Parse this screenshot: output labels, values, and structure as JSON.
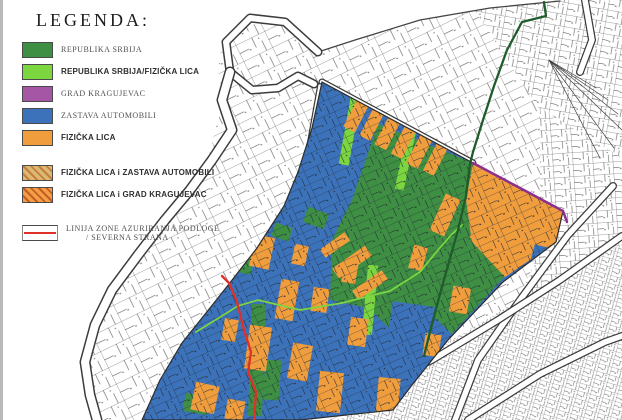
{
  "legend": {
    "title": "LEGENDA:",
    "items": [
      {
        "label": "REPUBLIKA SRBIJA",
        "style": "serif",
        "swatch": {
          "type": "solid",
          "color": "#3E8E43"
        }
      },
      {
        "label": "REPUBLIKA SRBIJA/FIZIČKA LICA",
        "style": "bold",
        "swatch": {
          "type": "solid",
          "color": "#7CD63F"
        }
      },
      {
        "label": "GRAD KRAGUJEVAC",
        "style": "serif",
        "swatch": {
          "type": "solid",
          "color": "#A557A5"
        }
      },
      {
        "label": "ZASTAVA AUTOMOBILI",
        "style": "serif",
        "swatch": {
          "type": "solid",
          "color": "#3B72BA"
        }
      },
      {
        "label": "FIZIČKA LICA",
        "style": "bold",
        "swatch": {
          "type": "solid",
          "color": "#F09D3D"
        }
      },
      {
        "label": "FIZIČKA LICA i ZASTAVA AUTOMOBILI",
        "style": "bold",
        "gap": "lg",
        "swatch": {
          "type": "hatch",
          "base": "#D9B878",
          "stripe": "#C87F35"
        }
      },
      {
        "label": "FIZIČKA LICA i GRAD KRAGUJEVAC",
        "style": "bold",
        "swatch": {
          "type": "hatch",
          "base": "#F0A043",
          "stripe": "#C85A28"
        }
      },
      {
        "label": "LINIJA ZONE AZURIRANJA PODLOGE",
        "label_line2": "/ SEVERNA STRANA",
        "style": "serif",
        "gap": "xl",
        "swatch": {
          "type": "redline",
          "color": "#E03028"
        }
      }
    ]
  },
  "map": {
    "palette": {
      "blue": "#3B72BA",
      "dark_green": "#3E8E43",
      "light_green": "#7CD63F",
      "orange": "#F09D3D",
      "purple": "#8E2F8E",
      "red": "#E03028",
      "dark_green_line": "#1E5C2A",
      "band_edge": "#3c3c3c",
      "white": "#ffffff",
      "zone_outline": "#2b2b2b"
    },
    "outer_top_boundary": [
      [
        560,
        1
      ],
      [
        490,
        8
      ],
      [
        420,
        20
      ],
      [
        355,
        40
      ],
      [
        318,
        52
      ]
    ],
    "white_left": [
      [
        0,
        0
      ],
      [
        300,
        0
      ],
      [
        312,
        46
      ],
      [
        282,
        20
      ],
      [
        248,
        16
      ],
      [
        222,
        40
      ],
      [
        218,
        72
      ],
      [
        224,
        100
      ],
      [
        214,
        135
      ],
      [
        208,
        160
      ],
      [
        186,
        192
      ],
      [
        160,
        224
      ],
      [
        133,
        258
      ],
      [
        107,
        292
      ],
      [
        90,
        327
      ],
      [
        80,
        364
      ],
      [
        85,
        397
      ],
      [
        92,
        420
      ],
      [
        0,
        420
      ]
    ],
    "white_top_wedge": [
      [
        300,
        0
      ],
      [
        560,
        0
      ],
      [
        490,
        8
      ],
      [
        420,
        20
      ],
      [
        355,
        40
      ],
      [
        318,
        52
      ],
      [
        312,
        46
      ]
    ],
    "hook_band": [
      [
        318,
        52
      ],
      [
        285,
        22
      ],
      [
        250,
        18
      ],
      [
        226,
        42
      ],
      [
        230,
        72
      ],
      [
        252,
        90
      ],
      [
        278,
        88
      ],
      [
        298,
        76
      ],
      [
        314,
        84
      ]
    ],
    "main_band": [
      [
        230,
        72
      ],
      [
        222,
        100
      ],
      [
        232,
        130
      ],
      [
        212,
        160
      ],
      [
        190,
        190
      ],
      [
        165,
        220
      ],
      [
        138,
        255
      ],
      [
        112,
        290
      ],
      [
        95,
        325
      ],
      [
        85,
        362
      ],
      [
        90,
        395
      ],
      [
        97,
        420
      ]
    ],
    "edge_road": [
      [
        322,
        82
      ],
      [
        473,
        163
      ]
    ],
    "left_edge_road": [
      [
        320,
        86
      ],
      [
        309,
        148
      ],
      [
        297,
        190
      ]
    ],
    "roads": [
      [
        [
          613,
          186
        ],
        [
          568,
          235
        ],
        [
          520,
          300
        ],
        [
          478,
          360
        ],
        [
          455,
          420
        ]
      ],
      [
        [
          622,
          236
        ],
        [
          560,
          280
        ],
        [
          498,
          320
        ],
        [
          432,
          360
        ],
        [
          352,
          396
        ],
        [
          298,
          418
        ]
      ],
      [
        [
          468,
          420
        ],
        [
          540,
          374
        ],
        [
          605,
          342
        ],
        [
          622,
          336
        ]
      ],
      [
        [
          585,
          0
        ],
        [
          592,
          40
        ],
        [
          580,
          72
        ]
      ]
    ],
    "fan_center": [
      549,
      60
    ],
    "fan_ends": [
      [
        596,
        88
      ],
      [
        608,
        100
      ],
      [
        618,
        114
      ],
      [
        622,
        130
      ],
      [
        614,
        148
      ],
      [
        600,
        158
      ]
    ],
    "districts": [
      {
        "poly": [
          [
            468,
            0
          ],
          [
            622,
            0
          ],
          [
            622,
            160
          ],
          [
            540,
            110
          ]
        ],
        "pattern": "pB"
      },
      {
        "poly": [
          [
            540,
            108
          ],
          [
            622,
            158
          ],
          [
            622,
            420
          ],
          [
            560,
            420
          ],
          [
            505,
            330
          ],
          [
            540,
            250
          ]
        ],
        "pattern": "pBr"
      },
      {
        "poly": [
          [
            340,
            420
          ],
          [
            448,
            342
          ],
          [
            530,
            294
          ],
          [
            622,
            244
          ],
          [
            622,
            420
          ]
        ],
        "pattern": "pC"
      }
    ],
    "zone": [
      [
        322,
        82
      ],
      [
        473,
        163
      ],
      [
        563,
        211
      ],
      [
        556,
        242
      ],
      [
        503,
        282
      ],
      [
        448,
        340
      ],
      [
        412,
        385
      ],
      [
        393,
        410
      ],
      [
        300,
        420
      ],
      [
        142,
        420
      ],
      [
        160,
        380
      ],
      [
        182,
        343
      ],
      [
        206,
        313
      ],
      [
        229,
        284
      ],
      [
        257,
        248
      ],
      [
        284,
        206
      ],
      [
        298,
        172
      ],
      [
        312,
        128
      ]
    ],
    "green_region": [
      [
        378,
        124
      ],
      [
        473,
        163
      ],
      [
        466,
        200
      ],
      [
        472,
        242
      ],
      [
        505,
        276
      ],
      [
        452,
        334
      ],
      [
        425,
        308
      ],
      [
        398,
        336
      ],
      [
        368,
        308
      ],
      [
        330,
        300
      ],
      [
        332,
        240
      ],
      [
        352,
        200
      ]
    ],
    "tip_orange": [
      [
        473,
        163
      ],
      [
        563,
        211
      ],
      [
        556,
        242
      ],
      [
        505,
        277
      ],
      [
        472,
        242
      ],
      [
        466,
        200
      ]
    ],
    "blue_in_green": [
      [
        [
          412,
          322,
          44,
          36,
          8
        ]
      ],
      [
        [
          540,
          256,
          16,
          20,
          15
        ]
      ]
    ],
    "green_in_blue": [
      [
        240,
        262,
        26,
        20,
        15
      ],
      [
        257,
        360,
        14,
        112,
        2
      ],
      [
        196,
        404,
        24,
        18,
        10
      ],
      [
        316,
        218,
        22,
        16,
        20
      ],
      [
        282,
        232,
        18,
        14,
        18
      ],
      [
        272,
        380,
        16,
        40,
        4
      ]
    ],
    "light_green_strips": [
      [
        352,
        118,
        10,
        95,
        10
      ],
      [
        408,
        148,
        9,
        85,
        12
      ],
      [
        370,
        300,
        10,
        70,
        5
      ]
    ],
    "orange_band": [
      [
        356,
        116,
        13,
        30,
        27
      ],
      [
        372,
        124,
        12,
        32,
        27
      ],
      [
        388,
        132,
        13,
        34,
        27
      ],
      [
        404,
        141,
        12,
        34,
        27
      ],
      [
        420,
        150,
        13,
        36,
        27
      ],
      [
        436,
        158,
        12,
        34,
        27
      ]
    ],
    "orange_parcels": [
      [
        262,
        252,
        20,
        32,
        12
      ],
      [
        287,
        300,
        18,
        40,
        10
      ],
      [
        258,
        348,
        22,
        44,
        8
      ],
      [
        300,
        362,
        20,
        36,
        10
      ],
      [
        205,
        398,
        24,
        28,
        12
      ],
      [
        235,
        410,
        18,
        20,
        10
      ],
      [
        330,
        392,
        24,
        40,
        6
      ],
      [
        358,
        332,
        18,
        28,
        8
      ],
      [
        388,
        398,
        22,
        40,
        5
      ],
      [
        350,
        272,
        14,
        22,
        10
      ],
      [
        418,
        258,
        14,
        24,
        15
      ],
      [
        300,
        255,
        14,
        20,
        12
      ],
      [
        320,
        300,
        16,
        24,
        8
      ],
      [
        230,
        330,
        14,
        22,
        10
      ],
      [
        352,
        262,
        40,
        12,
        -35
      ],
      [
        370,
        285,
        36,
        11,
        -35
      ],
      [
        335,
        245,
        30,
        10,
        -35
      ],
      [
        488,
        225,
        26,
        36,
        20
      ],
      [
        518,
        246,
        20,
        28,
        20
      ],
      [
        445,
        215,
        16,
        40,
        24
      ],
      [
        460,
        300,
        18,
        26,
        10
      ],
      [
        432,
        345,
        16,
        22,
        8
      ]
    ],
    "dark_green_line": [
      [
        544,
        2
      ],
      [
        546,
        16
      ],
      [
        522,
        22
      ],
      [
        507,
        50
      ],
      [
        494,
        86
      ],
      [
        483,
        120
      ],
      [
        473,
        152
      ],
      [
        470,
        164
      ],
      [
        466,
        196
      ],
      [
        458,
        230
      ],
      [
        449,
        262
      ],
      [
        440,
        294
      ],
      [
        431,
        328
      ],
      [
        424,
        356
      ]
    ],
    "purple_line": [
      [
        473,
        163
      ],
      [
        520,
        188
      ],
      [
        563,
        211
      ],
      [
        567,
        222
      ]
    ],
    "red_line": [
      [
        222,
        276
      ],
      [
        229,
        283
      ],
      [
        237,
        302
      ],
      [
        244,
        330
      ],
      [
        251,
        352
      ],
      [
        248,
        372
      ],
      [
        256,
        392
      ],
      [
        254,
        420
      ]
    ],
    "light_green_line": [
      [
        196,
        332
      ],
      [
        238,
        306
      ],
      [
        258,
        300
      ],
      [
        300,
        310
      ],
      [
        342,
        303
      ],
      [
        390,
        291
      ],
      [
        420,
        272
      ],
      [
        438,
        250
      ],
      [
        452,
        234
      ],
      [
        462,
        225
      ]
    ]
  }
}
